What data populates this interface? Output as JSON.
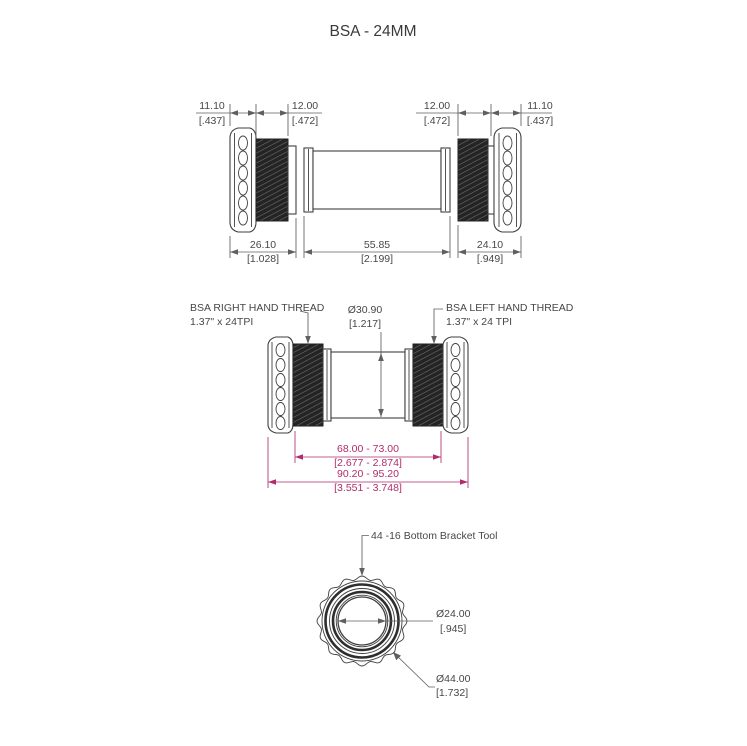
{
  "title": "BSA - 24MM",
  "colors": {
    "drawing_line": "#3f3f3f",
    "dimension_line": "#5f5f5f",
    "accent_dimension": "#b12d69",
    "background": "#ffffff"
  },
  "top_view": {
    "dims_top": [
      {
        "mm": "11.10",
        "in": "[.437]"
      },
      {
        "mm": "12.00",
        "in": "[.472]"
      },
      {
        "mm": "12.00",
        "in": "[.472]"
      },
      {
        "mm": "11.10",
        "in": "[.437]"
      }
    ],
    "dims_bottom": [
      {
        "mm": "26.10",
        "in": "[1.028]"
      },
      {
        "mm": "55.85",
        "in": "[2.199]"
      },
      {
        "mm": "24.10",
        "in": "[.949]"
      }
    ]
  },
  "middle_view": {
    "left_thread_line1": "BSA RIGHT HAND THREAD",
    "left_thread_line2": "1.37\" x 24TPI",
    "right_thread_line1": "BSA LEFT HAND THREAD",
    "right_thread_line2": "1.37\" x 24 TPI",
    "bore_dia_mm": "Ø30.90",
    "bore_dia_in": "[1.217]",
    "shell_width_mm": "68.00 - 73.00",
    "shell_width_in": "[2.677 - 2.874]",
    "overall_width_mm": "90.20 - 95.20",
    "overall_width_in": "[3.551 - 3.748]"
  },
  "bottom_view": {
    "tool_label": "44 -16 Bottom Bracket Tool",
    "inner_dia_mm": "Ø24.00",
    "inner_dia_in": "[.945]",
    "outer_dia_mm": "Ø44.00",
    "outer_dia_in": "[1.732]"
  }
}
